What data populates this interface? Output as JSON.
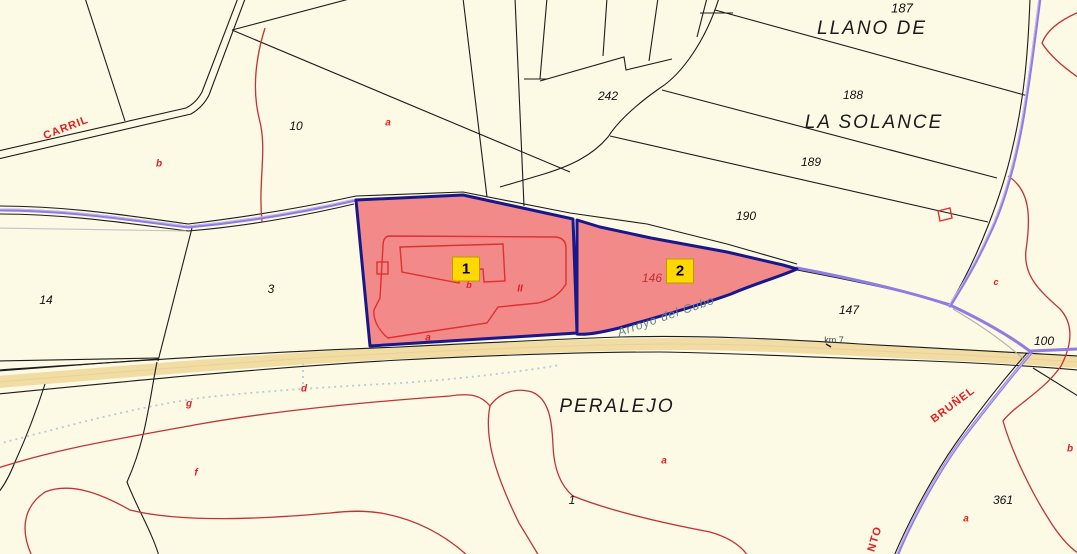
{
  "labels": {
    "top_clipped": "LLANO DE",
    "llano_de": "LLANO DE",
    "la_solance": "LA  SOLANCE",
    "peralejo": "PERALEJO",
    "carril": "CARRIL",
    "brunel": "BRUÑEL",
    "canto_fragment": "NTO",
    "arroyo_del_cubo": "Arroyo del Cubo",
    "km_marker": "km 7",
    "parcel_187": "187",
    "parcel_188": "188",
    "parcel_189": "189",
    "parcel_190": "190",
    "parcel_242": "242",
    "parcel_10": "10",
    "parcel_3": "3",
    "parcel_14": "14",
    "parcel_146": "146",
    "parcel_147": "147",
    "parcel_100": "100",
    "parcel_361": "361",
    "parcel_1": "1",
    "letter_a": "a",
    "letter_b": "b",
    "letter_c": "c",
    "letter_d": "d",
    "letter_f": "f",
    "letter_g": "g",
    "letter_bars": "II"
  },
  "markers": {
    "one": "1",
    "two": "2"
  },
  "colors": {
    "background": "#fcf9e4",
    "highlight_fill": "#f38a8a",
    "highlight_border": "#18188c",
    "marker_yellow": "#ffd800",
    "path_purple": "#8e7ce2",
    "road_tan": "#f1dca4",
    "contour_red": "#c03437",
    "label_red": "#e02020",
    "water_label": "#66808e",
    "dashed_blue": "#b9c9da",
    "line_black": "#1c1c1c"
  }
}
